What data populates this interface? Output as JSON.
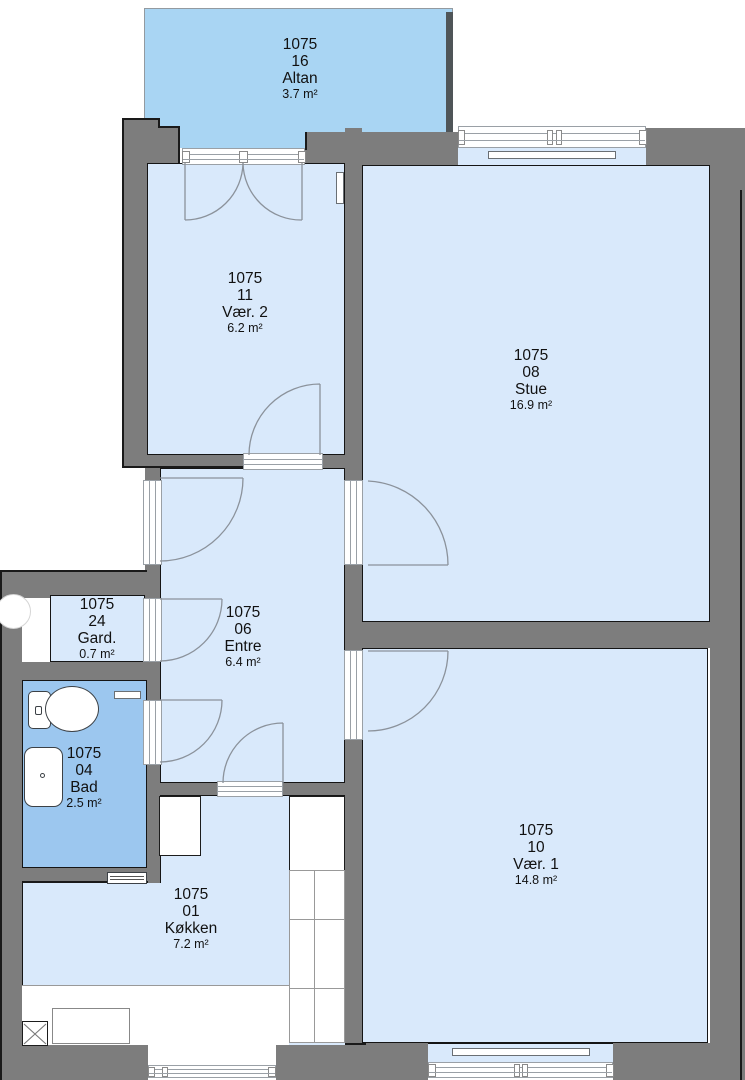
{
  "plan": {
    "rooms": [
      {
        "id": "altan",
        "unit": "1075",
        "number": "16",
        "name": "Altan",
        "area": "3.7 m²"
      },
      {
        "id": "vaer2",
        "unit": "1075",
        "number": "11",
        "name": "Vær. 2",
        "area": "6.2 m²"
      },
      {
        "id": "stue",
        "unit": "1075",
        "number": "08",
        "name": "Stue",
        "area": "16.9 m²"
      },
      {
        "id": "gard",
        "unit": "1075",
        "number": "24",
        "name": "Gard.",
        "area": "0.7 m²"
      },
      {
        "id": "entre",
        "unit": "1075",
        "number": "06",
        "name": "Entre",
        "area": "6.4 m²"
      },
      {
        "id": "bad",
        "unit": "1075",
        "number": "04",
        "name": "Bad",
        "area": "2.5 m²"
      },
      {
        "id": "vaer1",
        "unit": "1075",
        "number": "10",
        "name": "Vær. 1",
        "area": "14.8 m²"
      },
      {
        "id": "koekken",
        "unit": "1075",
        "number": "01",
        "name": "Køkken",
        "area": "7.2 m²"
      }
    ],
    "fixtures": [
      "toilet-icon",
      "sink-icon",
      "column-icon",
      "appliance-x-icon",
      "radiator",
      "door-arc",
      "window"
    ],
    "colors": {
      "wall": "#7d7d7d",
      "room_fill": "#d9e9fb",
      "wet_fill": "#9cc7ef",
      "balcony_fill": "#a9d5f3",
      "outline": "#1a1a1a",
      "door_arc": "#8b929b"
    }
  }
}
